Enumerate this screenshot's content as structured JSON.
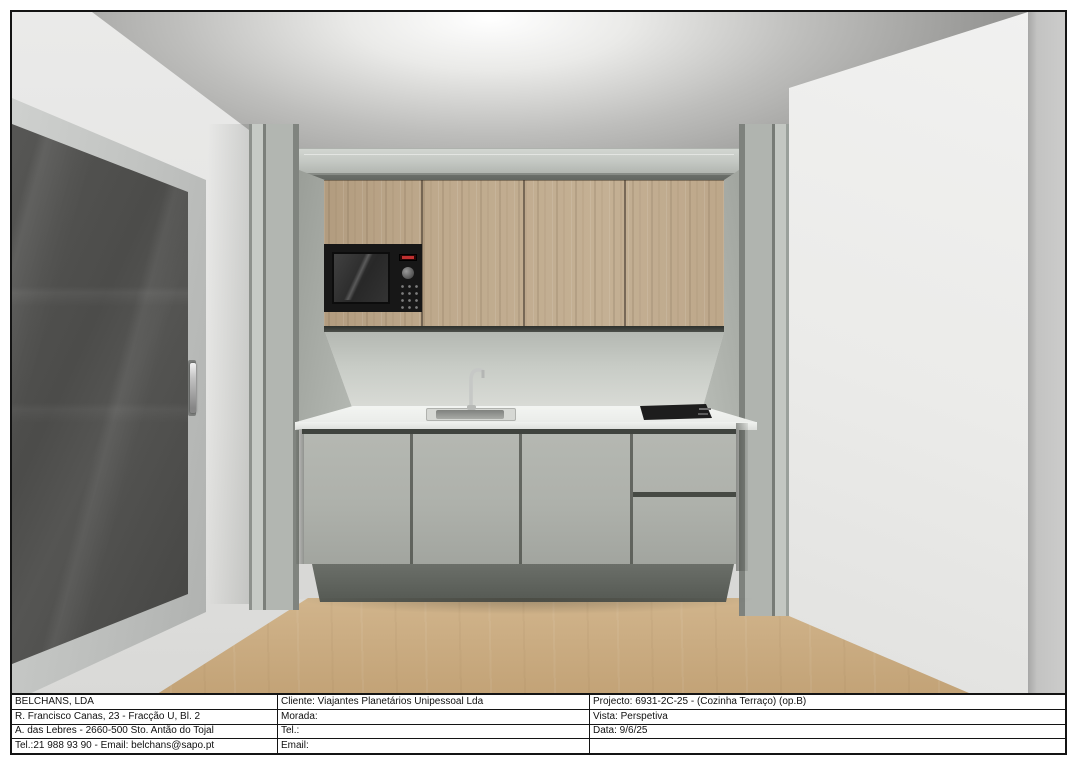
{
  "colors": {
    "sheet_border": "#141414",
    "upper_cabinet_wood": "#bfaa8d",
    "base_cabinet_gray": "#aeb1ab",
    "pilaster_gray": "#b2b6b1",
    "countertop_white": "#f2f4f1",
    "backsplash_gray": "#cdd1cb",
    "floor_wood": "#cdb087",
    "glass_door_dark": "#4e4e4c",
    "microwave_black": "#171717",
    "microwave_display_red": "#c03030",
    "ceiling_glow": "#ffffff"
  },
  "info_table": {
    "rows": [
      [
        "BELCHANS, LDA",
        "Cliente: Viajantes Planetários Unipessoal Lda",
        "Projecto: 6931-2C-25 - (Cozinha Terraço) (op.B)"
      ],
      [
        "R. Francisco Canas, 23 - Fracção U, Bl. 2",
        "Morada:",
        "Vista: Perspetiva"
      ],
      [
        "A. das Lebres - 2660-500 Sto. Antão do Tojal",
        "Tel.:",
        "Data: 9/6/25"
      ],
      [
        "Tel.:21 988 93 90 - Email: belchans@sapo.pt",
        "Email:",
        ""
      ]
    ]
  }
}
